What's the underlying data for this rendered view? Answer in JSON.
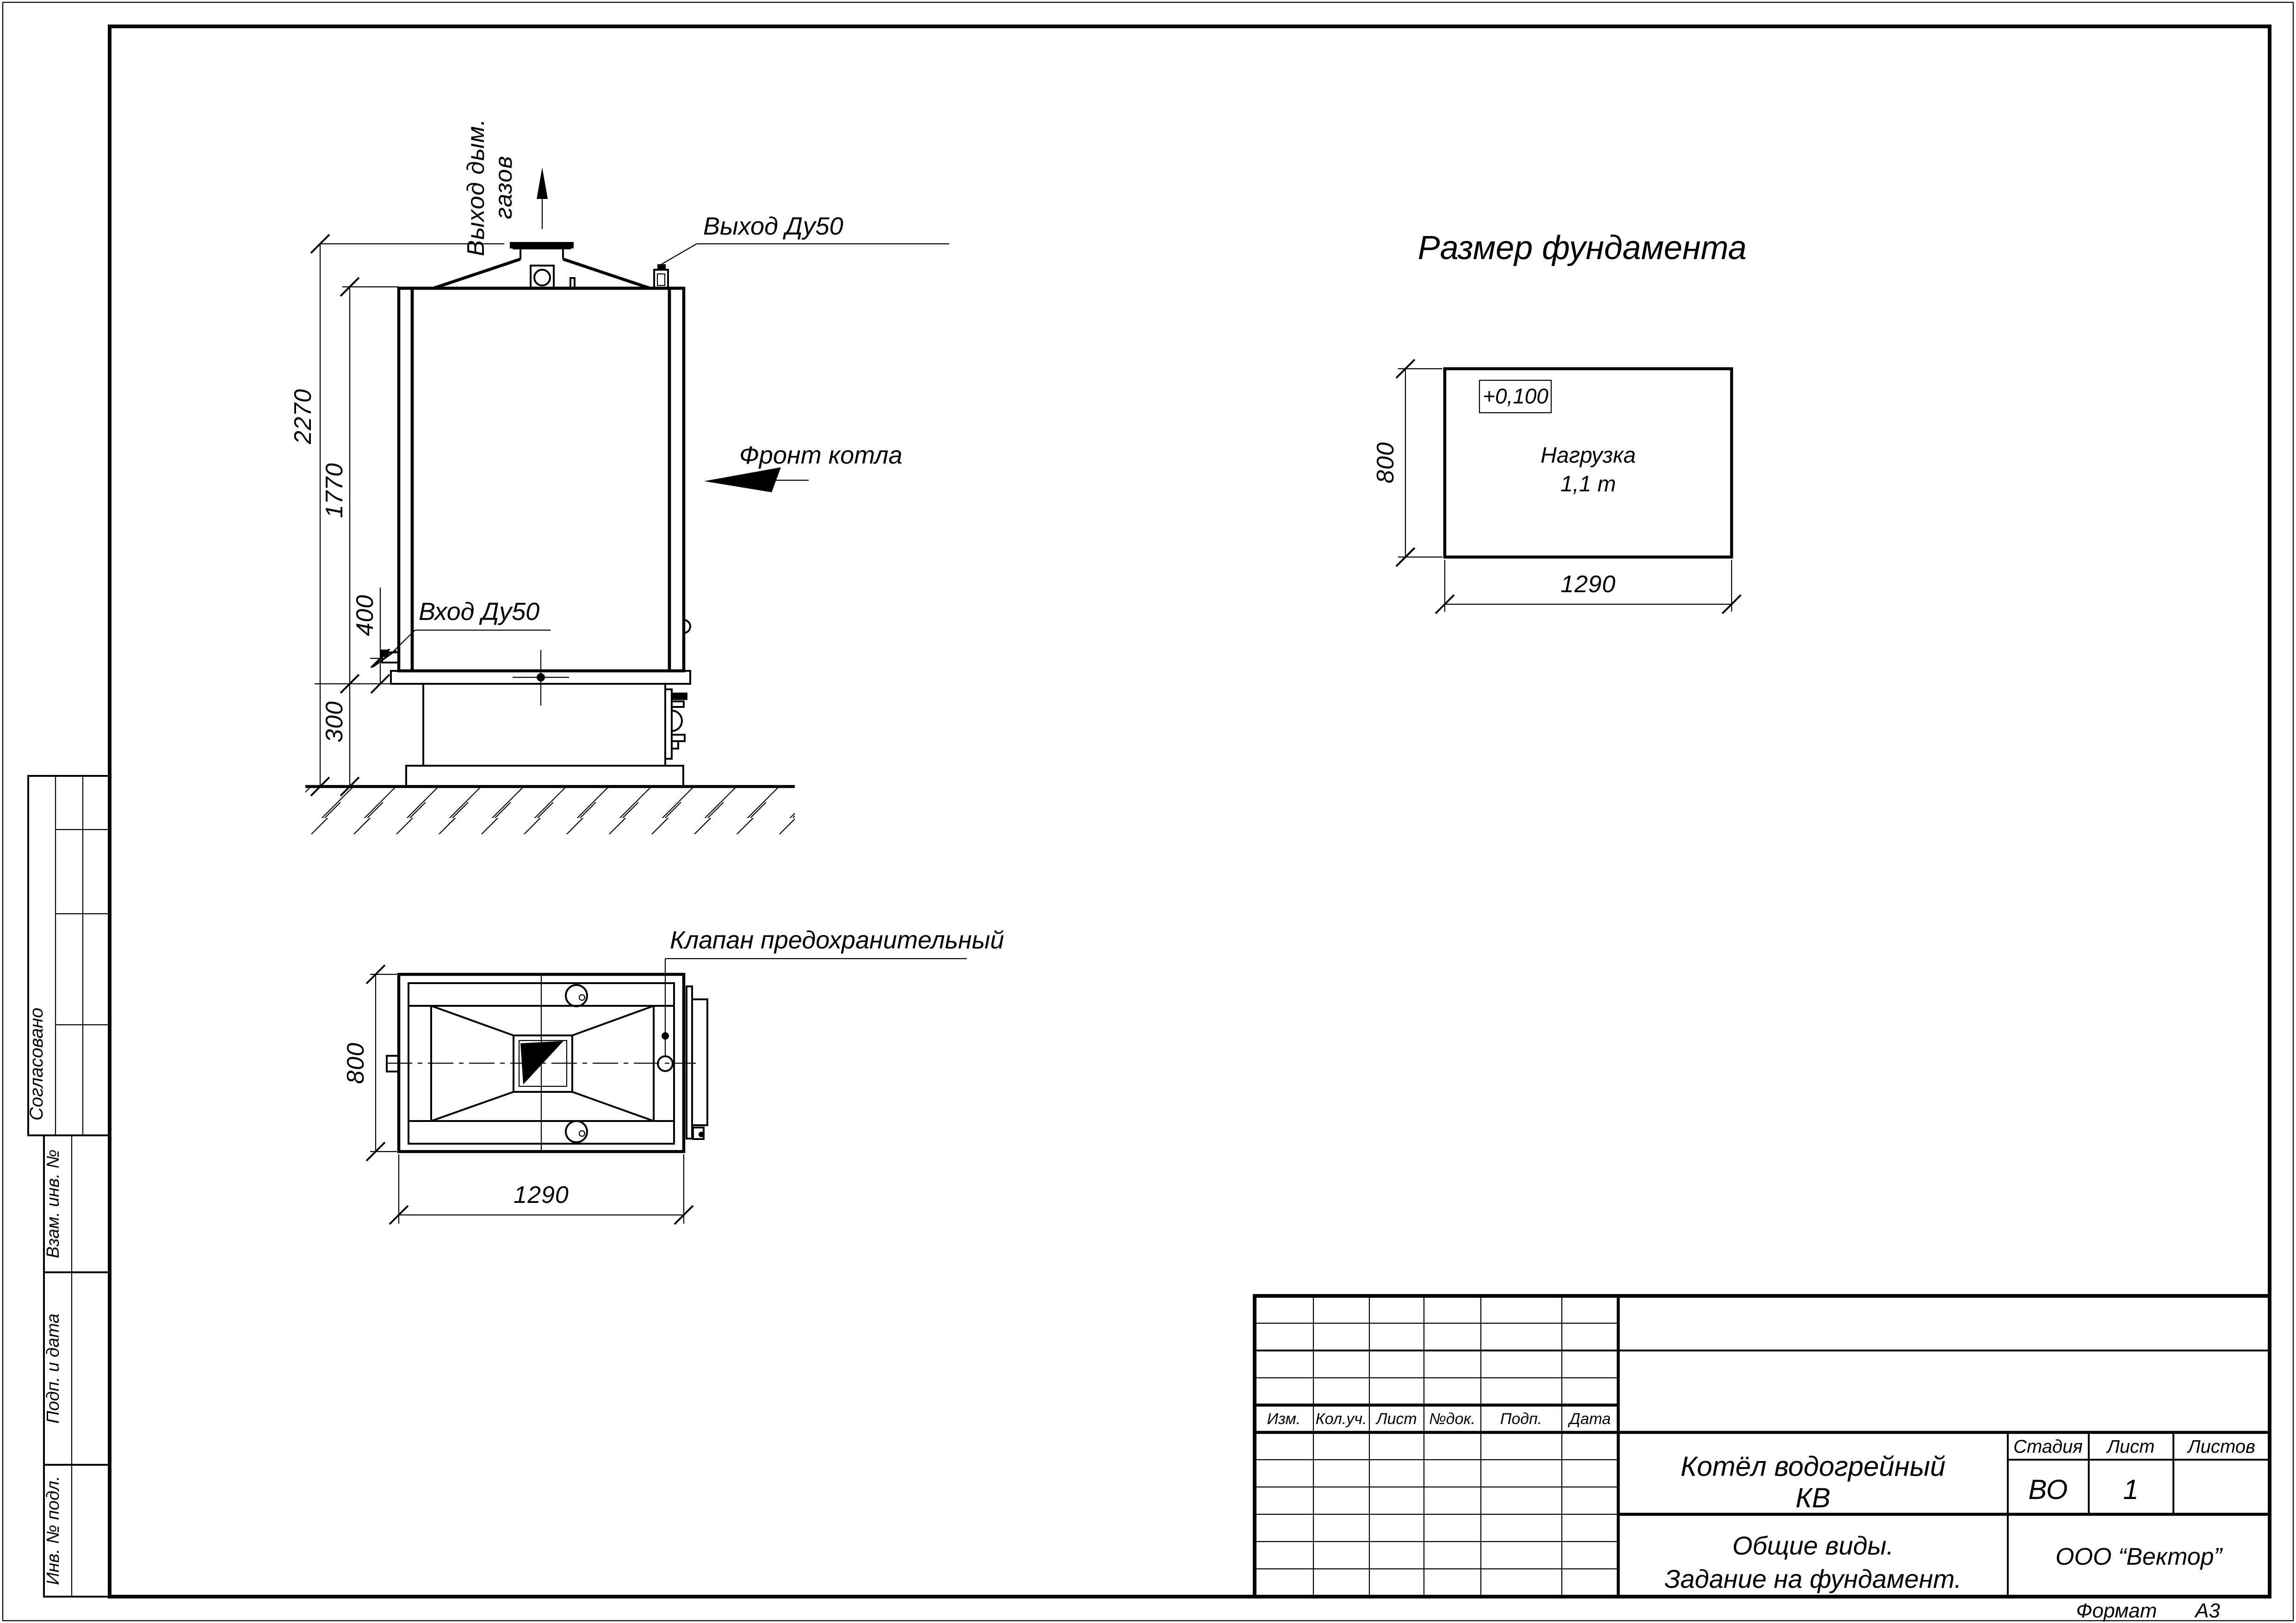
{
  "page": {
    "format_label": "Формат",
    "format_value": "А3"
  },
  "front_view": {
    "labels": {
      "flue_line1": "Выход дым.",
      "flue_line2": "газов",
      "outlet": "Выход Ду50",
      "inlet": "Вход Ду50",
      "front": "Фронт котла"
    },
    "dims": {
      "total_height": "2270",
      "body_height": "1770",
      "inlet_height": "400",
      "base_height": "300"
    }
  },
  "plan_view": {
    "labels": {
      "safety_valve": "Клапан предохранительный"
    },
    "dims": {
      "width": "1290",
      "depth": "800"
    }
  },
  "foundation": {
    "title": "Размер фундамента",
    "elevation": "+0,100",
    "load_line1": "Нагрузка",
    "load_line2": "1,1 т",
    "dims": {
      "width": "1290",
      "depth": "800"
    }
  },
  "title_block": {
    "rev_headers": [
      "Изм.",
      "Кол.уч.",
      "Лист",
      "№док.",
      "Подп.",
      "Дата"
    ],
    "doc_name_line1": "Котёл водогрейный",
    "doc_name_line2": "КВ",
    "stage_label": "Стадия",
    "sheet_label": "Лист",
    "sheets_label": "Листов",
    "stage_value": "ВО",
    "sheet_value": "1",
    "sheets_value": "",
    "subtitle_line1": "Общие виды.",
    "subtitle_line2": "Задание на фундамент.",
    "company": "ООО “Вектор”"
  },
  "side_stamps": {
    "agreed": "Согласовано",
    "replace_inv": "Взам. инв. №",
    "sign_date": "Подп. и дата",
    "inv_orig": "Инв. № подл."
  }
}
